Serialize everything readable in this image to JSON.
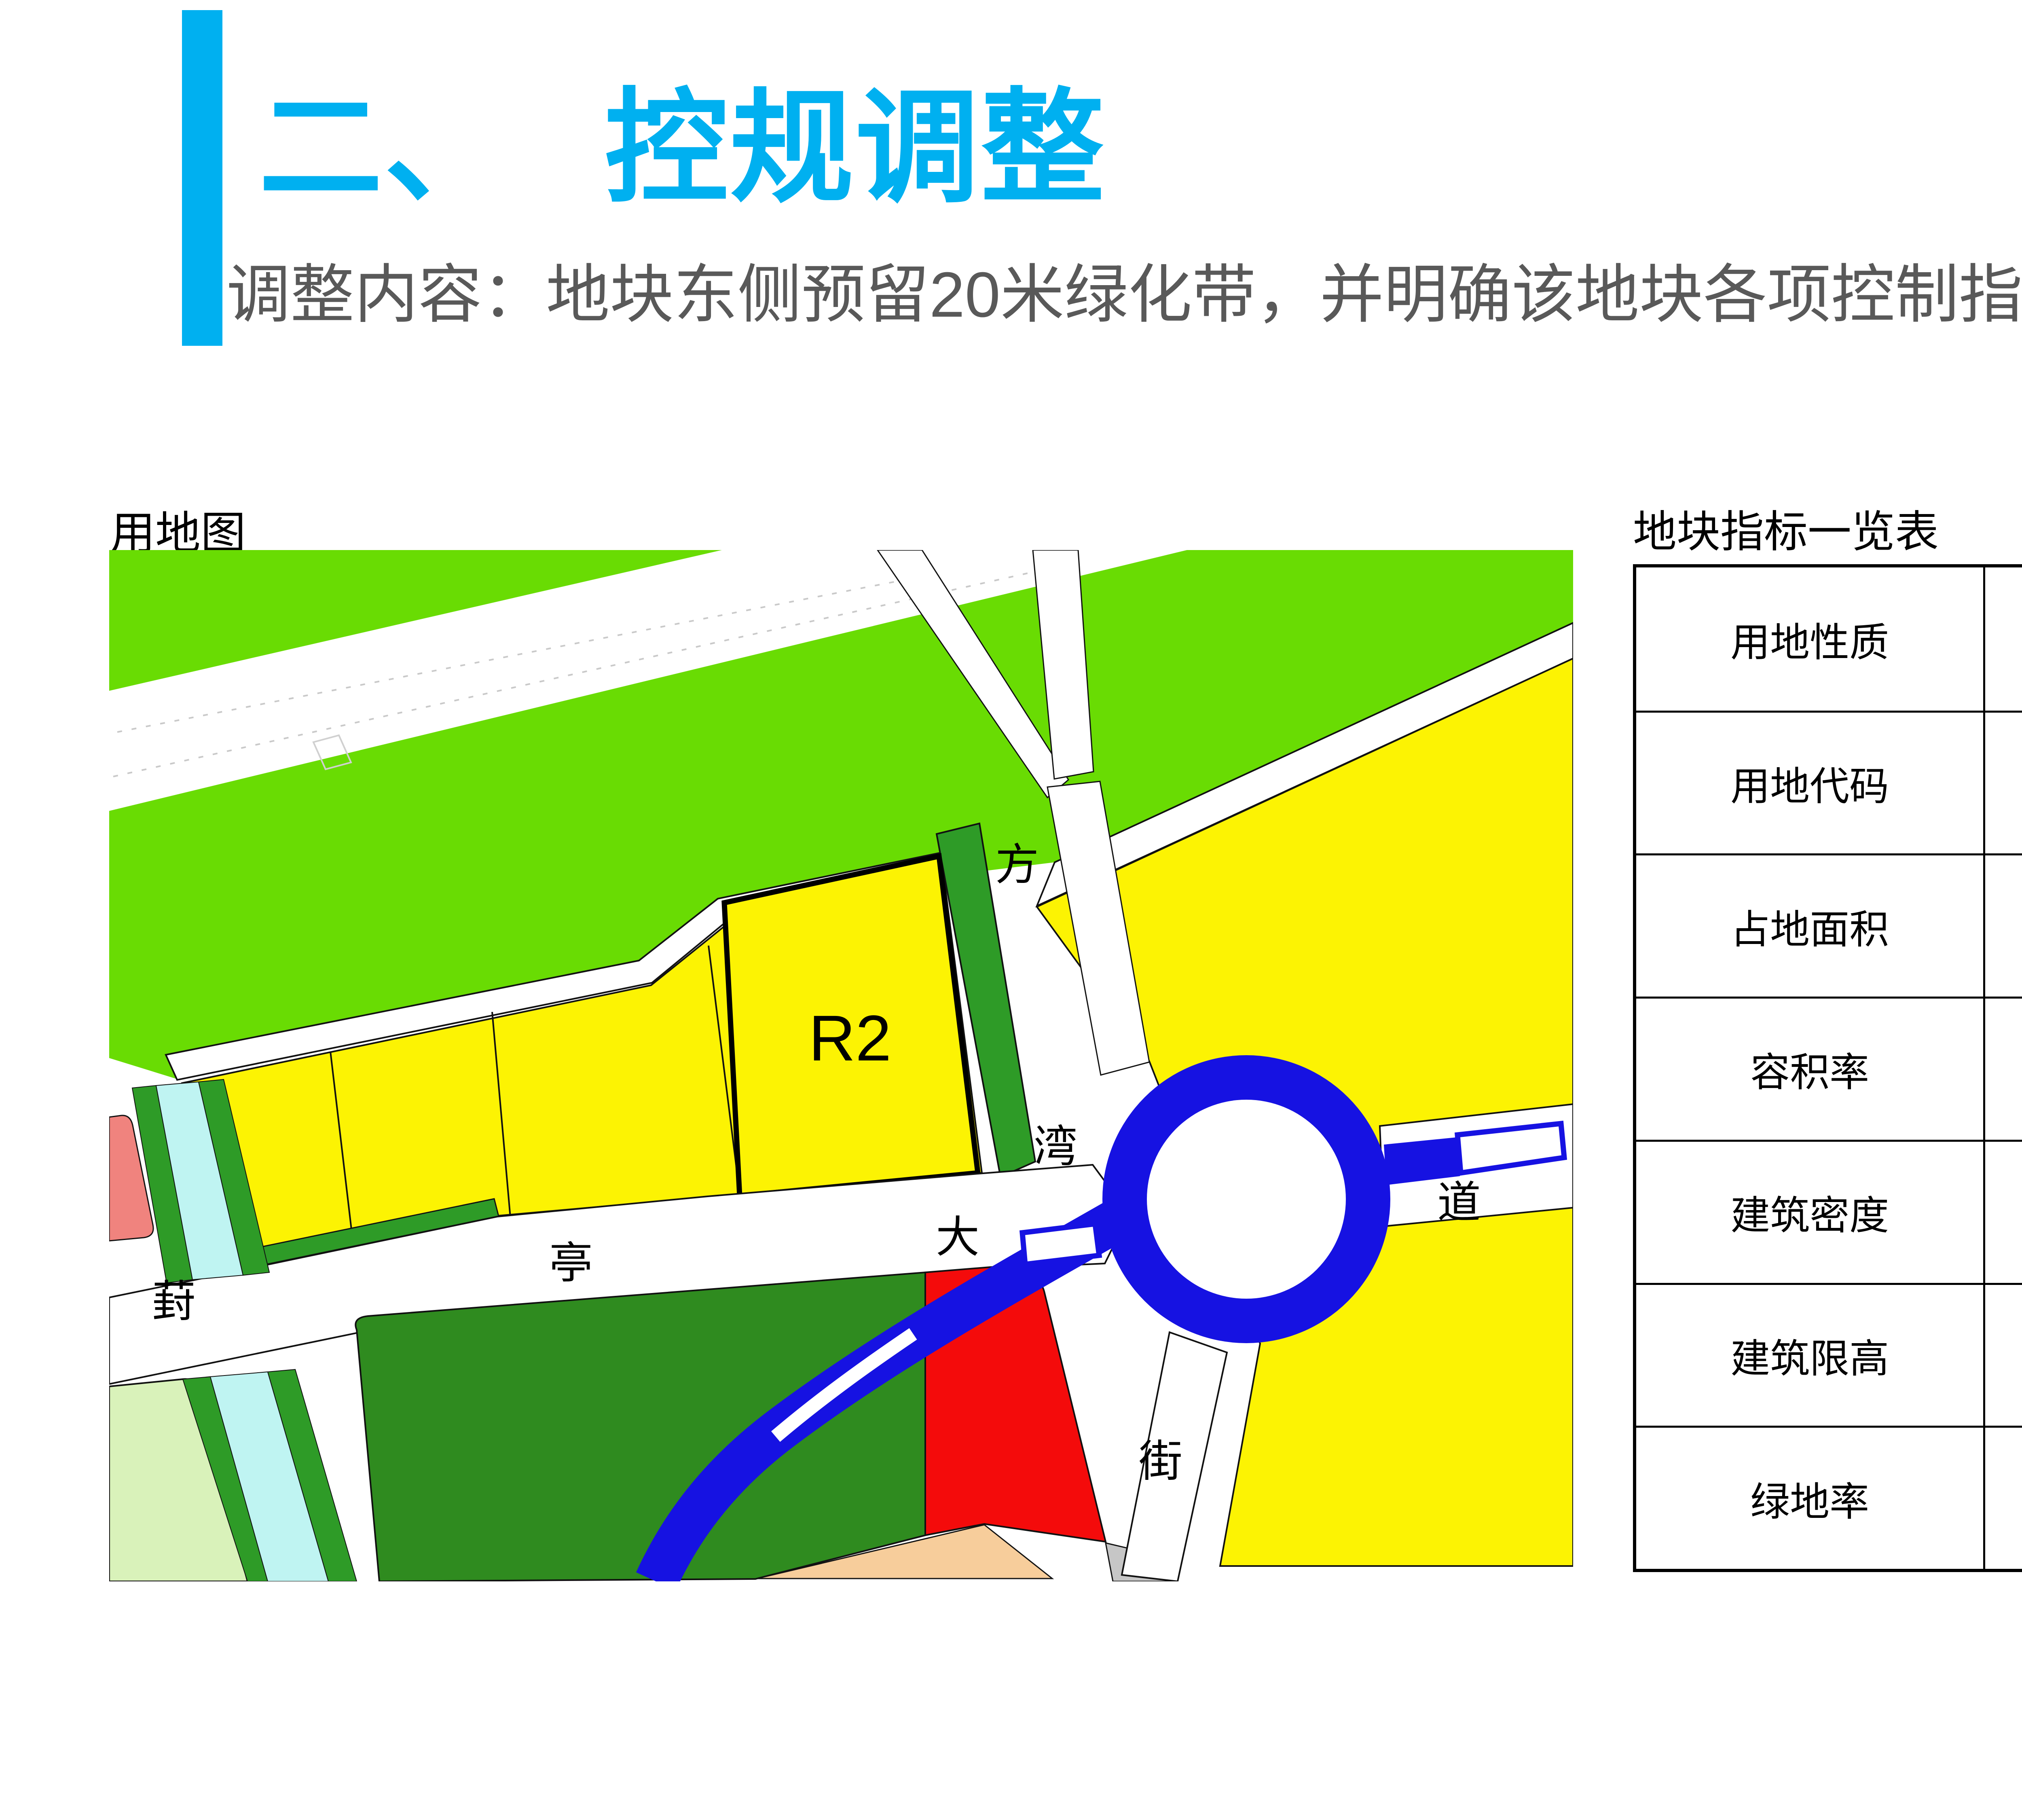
{
  "slide": {
    "title_prefix": "二、",
    "title_main": "控规调整",
    "subtitle": "调整内容：地块东侧预留20米绿化带，并明确该地块各项控制指标。",
    "accent_color": "#00B0F0",
    "subtitle_color": "#595959"
  },
  "map": {
    "caption": "用地图",
    "parcel_code": "R2",
    "labels": {
      "north_road_char1": "方",
      "north_road_char2": "湾",
      "south_road_char": "街",
      "avenue_char1": "葑",
      "avenue_char2": "亭",
      "avenue_char3": "大",
      "avenue_char4": "道"
    },
    "colors": {
      "greenbelt_bright": "#69DC03",
      "residential_yellow": "#FCF303",
      "green_strip": "#2E9B27",
      "park_dark_green": "#2F8B1F",
      "water_cyan": "#BFF4F2",
      "pink_parcel": "#F0837E",
      "pale_green_parcel": "#D9F2BA",
      "peach_parcel": "#F7CD9B",
      "gray_parcel": "#C6C6C6",
      "blue_road": "#1612E2",
      "red_parcel": "#F40B0B"
    }
  },
  "table": {
    "title": "地块指标一览表",
    "rows": [
      {
        "label": "用地性质",
        "value": "二类居住用地"
      },
      {
        "label": "用地代码",
        "value": "R2"
      },
      {
        "label": "占地面积",
        "value": "2.18公顷"
      },
      {
        "label": "容积率",
        "value": "1.5-1.6"
      },
      {
        "label": "建筑密度",
        "value": "25%"
      },
      {
        "label": "建筑限高",
        "value": "60米"
      },
      {
        "label": "绿地率",
        "value": "35%-50%"
      }
    ]
  }
}
